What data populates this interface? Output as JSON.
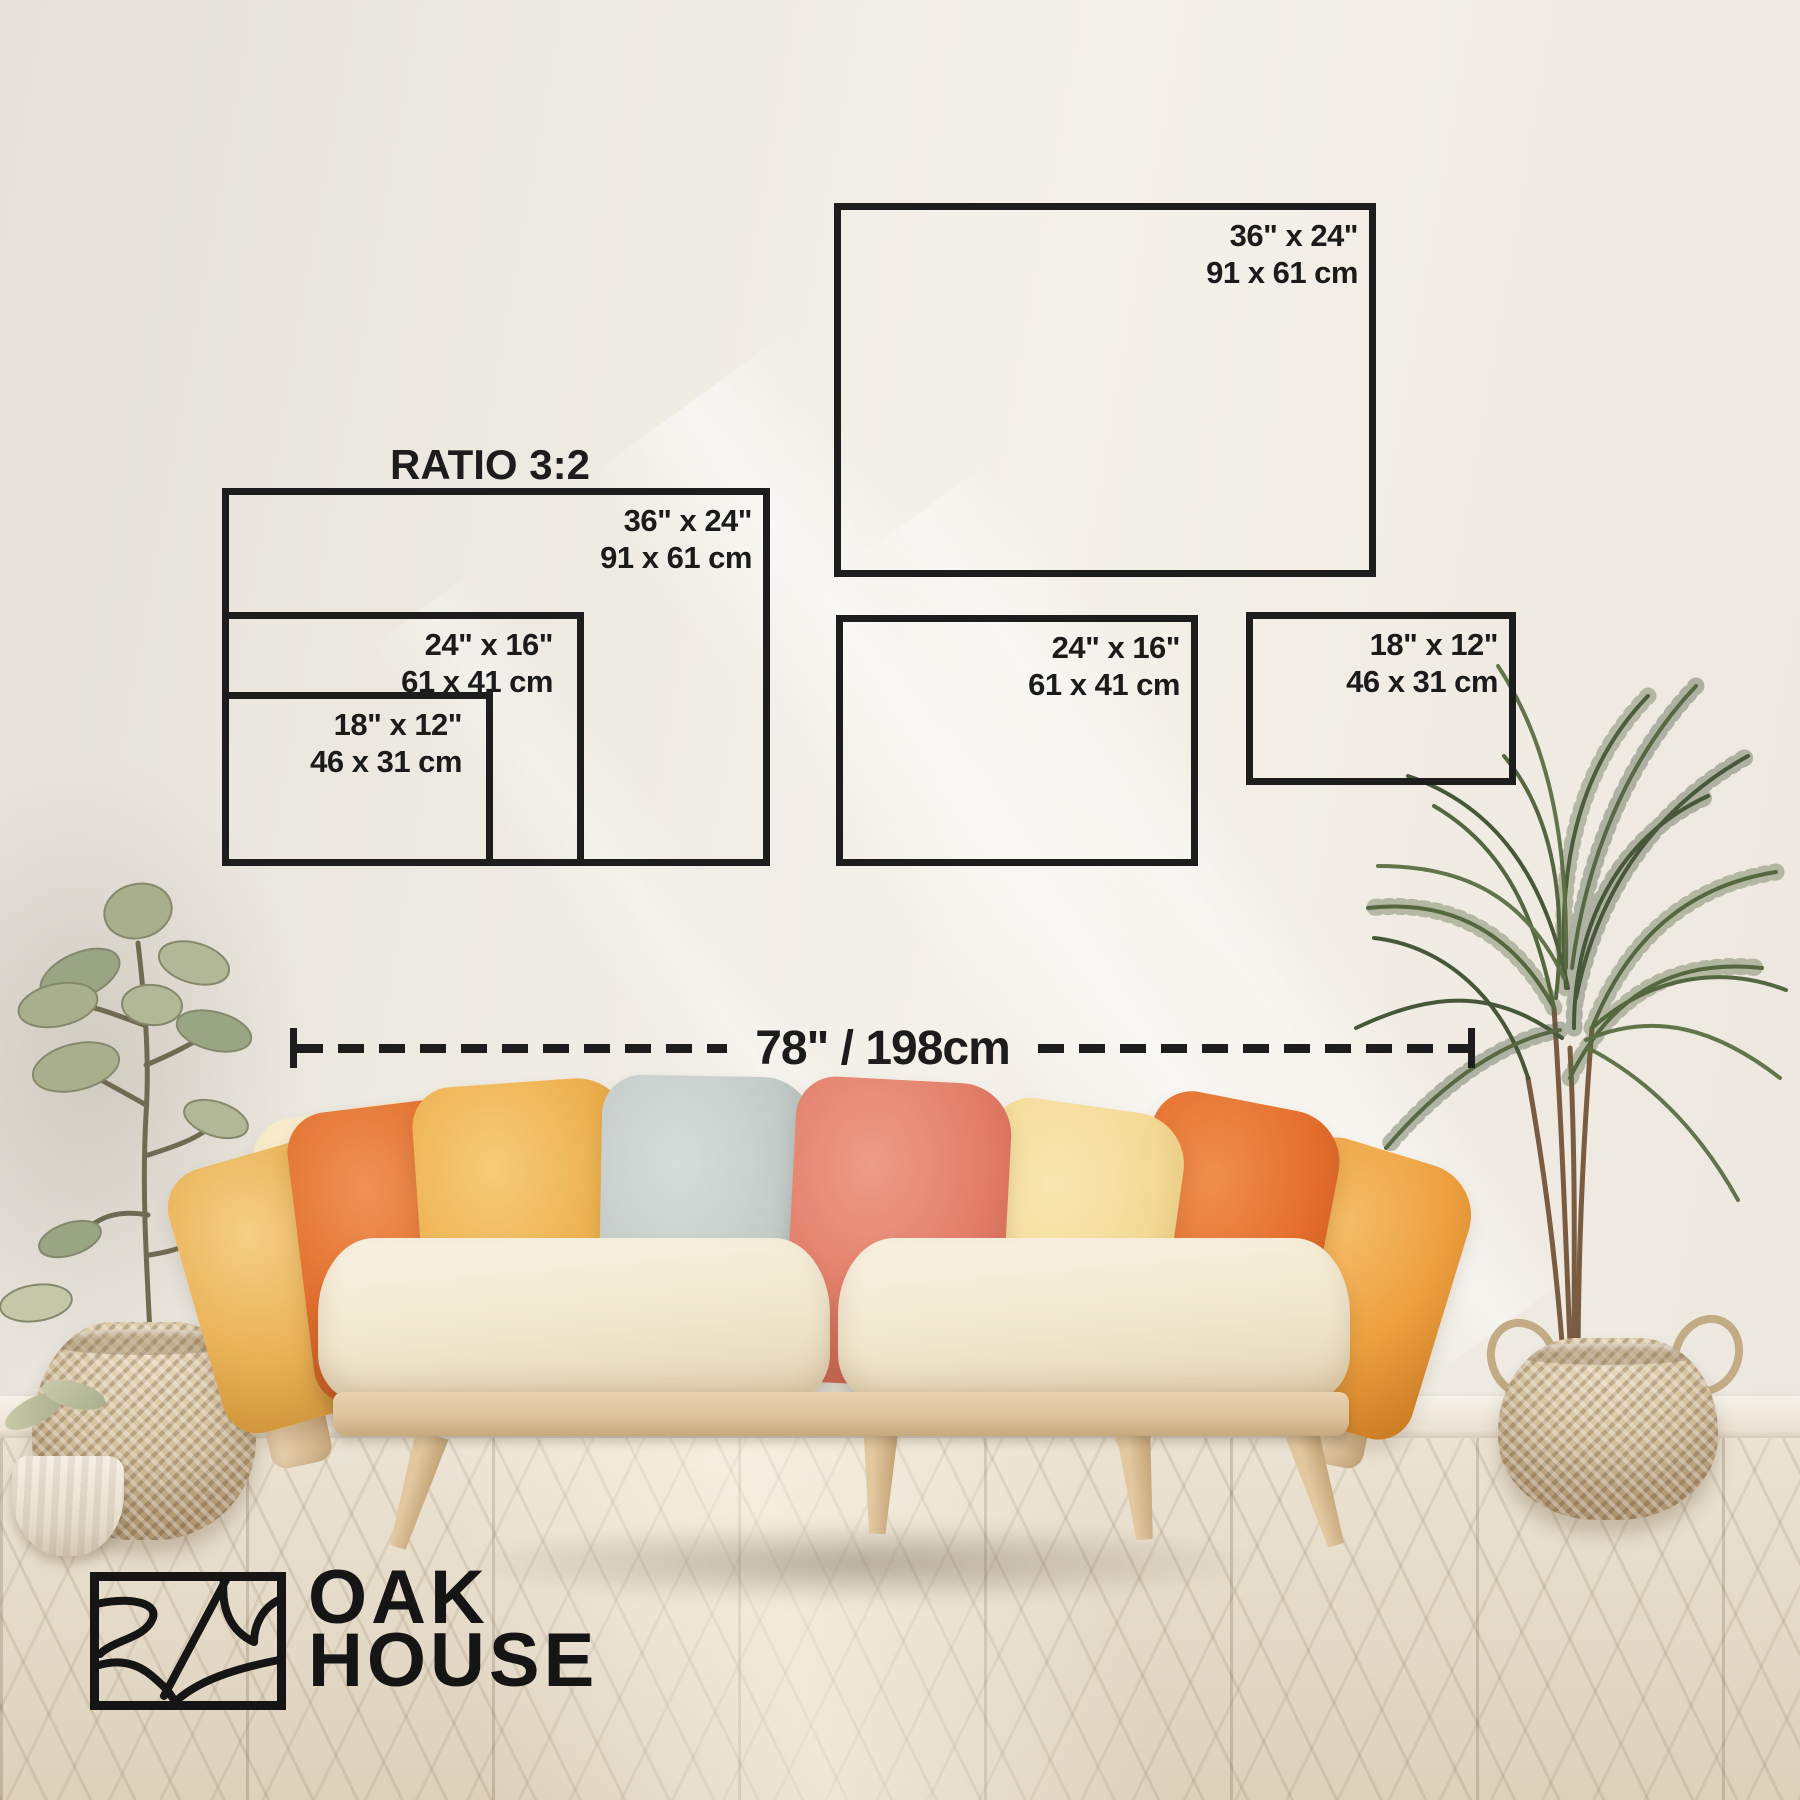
{
  "size_guide": {
    "ratio_title": "RATIO 3:2",
    "nested_frames": [
      {
        "id": "36x24",
        "inches": "36\" x 24\"",
        "cm": "91 x 61 cm"
      },
      {
        "id": "24x16",
        "inches": "24\" x 16\"",
        "cm": "61 x 41 cm"
      },
      {
        "id": "18x12",
        "inches": "18\" x 12\"",
        "cm": "46 x 31 cm"
      }
    ],
    "single_frames": [
      {
        "id": "36x24",
        "inches": "36\" x 24\"",
        "cm": "91 x 61 cm"
      },
      {
        "id": "24x16",
        "inches": "24\" x 16\"",
        "cm": "61 x 41 cm"
      },
      {
        "id": "18x12",
        "inches": "18\" x 12\"",
        "cm": "46 x 31 cm"
      }
    ]
  },
  "measurement": {
    "width_label": "78\" / 198cm"
  },
  "brand": {
    "name": "OAK HOUSE",
    "line1": "OAK",
    "line2": "HOUSE",
    "logo_icon": "oak-house-abstract-landscape-emblem"
  },
  "palette": {
    "outline": "#1d1d1d",
    "wall": "#efece5",
    "baseboard": "#f0ebe0",
    "floor_wood": "#e4dac8",
    "sofa_wood": "#dcc29b",
    "seat_cushion": "#f1e7cf",
    "pillows": [
      "#f4e7c3",
      "#e9b155",
      "#e2702e",
      "#edb04e",
      "#c3cbc9",
      "#e27e69",
      "#f3d994",
      "#eda03f",
      "#e46e2d"
    ],
    "basket": "#d5c19e",
    "leaf_sage": "#a9ae8d",
    "palm_green": "#55673f"
  }
}
